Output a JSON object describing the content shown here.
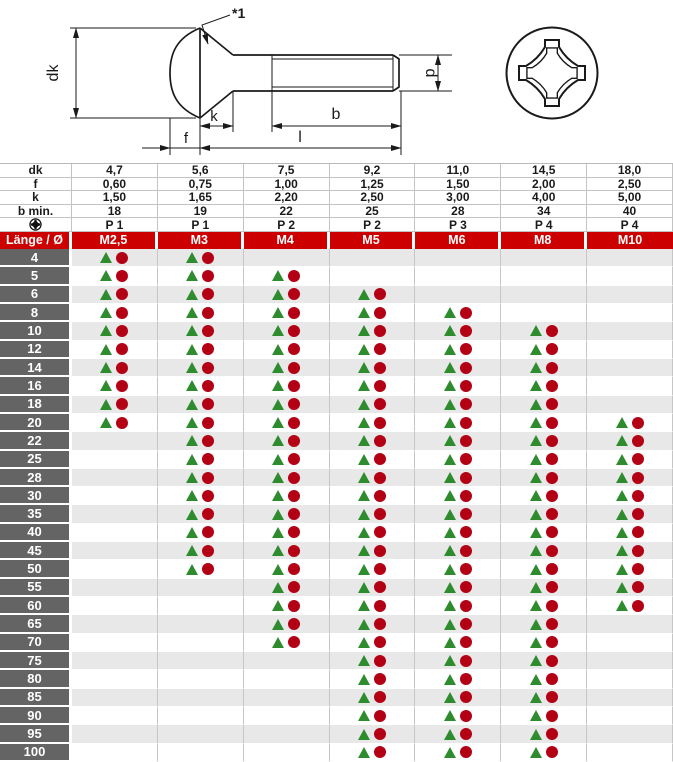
{
  "drawing": {
    "note": "*1",
    "labels": {
      "dk": "dk",
      "k": "k",
      "f": "f",
      "b": "b",
      "l": "l",
      "d": "d"
    },
    "icons": {
      "screw_side_view": "lens-head-screw-side-view",
      "recess_top_view": "phillips-recess-top-view"
    }
  },
  "table": {
    "corner": "Länge / Ø",
    "columns": [
      "M2,5",
      "M3",
      "M4",
      "M5",
      "M6",
      "M8",
      "M10"
    ],
    "specs": [
      {
        "label": "dk",
        "values": [
          "4,7",
          "5,6",
          "7,5",
          "9,2",
          "11,0",
          "14,5",
          "18,0"
        ]
      },
      {
        "label": "f",
        "values": [
          "0,60",
          "0,75",
          "1,00",
          "1,25",
          "1,50",
          "2,00",
          "2,50"
        ]
      },
      {
        "label": "k",
        "values": [
          "1,50",
          "1,65",
          "2,20",
          "2,50",
          "3,00",
          "4,00",
          "5,00"
        ]
      },
      {
        "label": "b min.",
        "values": [
          "18",
          "19",
          "22",
          "25",
          "28",
          "34",
          "40"
        ]
      },
      {
        "label": "",
        "icon": "phillips-cross-icon",
        "values": [
          "P 1",
          "P 1",
          "P 2",
          "P 2",
          "P 3",
          "P 4",
          "P 4"
        ]
      }
    ],
    "rows": [
      {
        "length": "4",
        "cells": [
          1,
          1,
          0,
          0,
          0,
          0,
          0
        ]
      },
      {
        "length": "5",
        "cells": [
          1,
          1,
          1,
          0,
          0,
          0,
          0
        ]
      },
      {
        "length": "6",
        "cells": [
          1,
          1,
          1,
          1,
          0,
          0,
          0
        ]
      },
      {
        "length": "8",
        "cells": [
          1,
          1,
          1,
          1,
          1,
          0,
          0
        ]
      },
      {
        "length": "10",
        "cells": [
          1,
          1,
          1,
          1,
          1,
          1,
          0
        ]
      },
      {
        "length": "12",
        "cells": [
          1,
          1,
          1,
          1,
          1,
          1,
          0
        ]
      },
      {
        "length": "14",
        "cells": [
          1,
          1,
          1,
          1,
          1,
          1,
          0
        ]
      },
      {
        "length": "16",
        "cells": [
          1,
          1,
          1,
          1,
          1,
          1,
          0
        ]
      },
      {
        "length": "18",
        "cells": [
          1,
          1,
          1,
          1,
          1,
          1,
          0
        ]
      },
      {
        "length": "20",
        "cells": [
          1,
          1,
          1,
          1,
          1,
          1,
          1
        ]
      },
      {
        "length": "22",
        "cells": [
          0,
          1,
          1,
          1,
          1,
          1,
          1
        ]
      },
      {
        "length": "25",
        "cells": [
          0,
          1,
          1,
          1,
          1,
          1,
          1
        ]
      },
      {
        "length": "28",
        "cells": [
          0,
          1,
          1,
          1,
          1,
          1,
          1
        ]
      },
      {
        "length": "30",
        "cells": [
          0,
          1,
          1,
          1,
          1,
          1,
          1
        ]
      },
      {
        "length": "35",
        "cells": [
          0,
          1,
          1,
          1,
          1,
          1,
          1
        ]
      },
      {
        "length": "40",
        "cells": [
          0,
          1,
          1,
          1,
          1,
          1,
          1
        ]
      },
      {
        "length": "45",
        "cells": [
          0,
          1,
          1,
          1,
          1,
          1,
          1
        ]
      },
      {
        "length": "50",
        "cells": [
          0,
          1,
          1,
          1,
          1,
          1,
          1
        ]
      },
      {
        "length": "55",
        "cells": [
          0,
          0,
          1,
          1,
          1,
          1,
          1
        ]
      },
      {
        "length": "60",
        "cells": [
          0,
          0,
          1,
          1,
          1,
          1,
          1
        ]
      },
      {
        "length": "65",
        "cells": [
          0,
          0,
          1,
          1,
          1,
          1,
          0
        ]
      },
      {
        "length": "70",
        "cells": [
          0,
          0,
          1,
          1,
          1,
          1,
          0
        ]
      },
      {
        "length": "75",
        "cells": [
          0,
          0,
          0,
          1,
          1,
          1,
          0
        ]
      },
      {
        "length": "80",
        "cells": [
          0,
          0,
          0,
          1,
          1,
          1,
          0
        ]
      },
      {
        "length": "85",
        "cells": [
          0,
          0,
          0,
          1,
          1,
          1,
          0
        ]
      },
      {
        "length": "90",
        "cells": [
          0,
          0,
          0,
          1,
          1,
          1,
          0
        ]
      },
      {
        "length": "95",
        "cells": [
          0,
          0,
          0,
          1,
          1,
          1,
          0
        ]
      },
      {
        "length": "100",
        "cells": [
          0,
          0,
          0,
          1,
          1,
          1,
          0
        ]
      }
    ],
    "markers": {
      "triangle": "triangle-marker",
      "circle": "circle-marker"
    }
  },
  "colors": {
    "header_red": "#cc0001",
    "row_label_gray": "#646464",
    "alt_row_gray": "#e8e8e8",
    "grid_line": "#c6c6c6",
    "triangle_green": "#2e8b2e",
    "circle_red": "#b30014",
    "line_black": "#1a1a1a"
  }
}
